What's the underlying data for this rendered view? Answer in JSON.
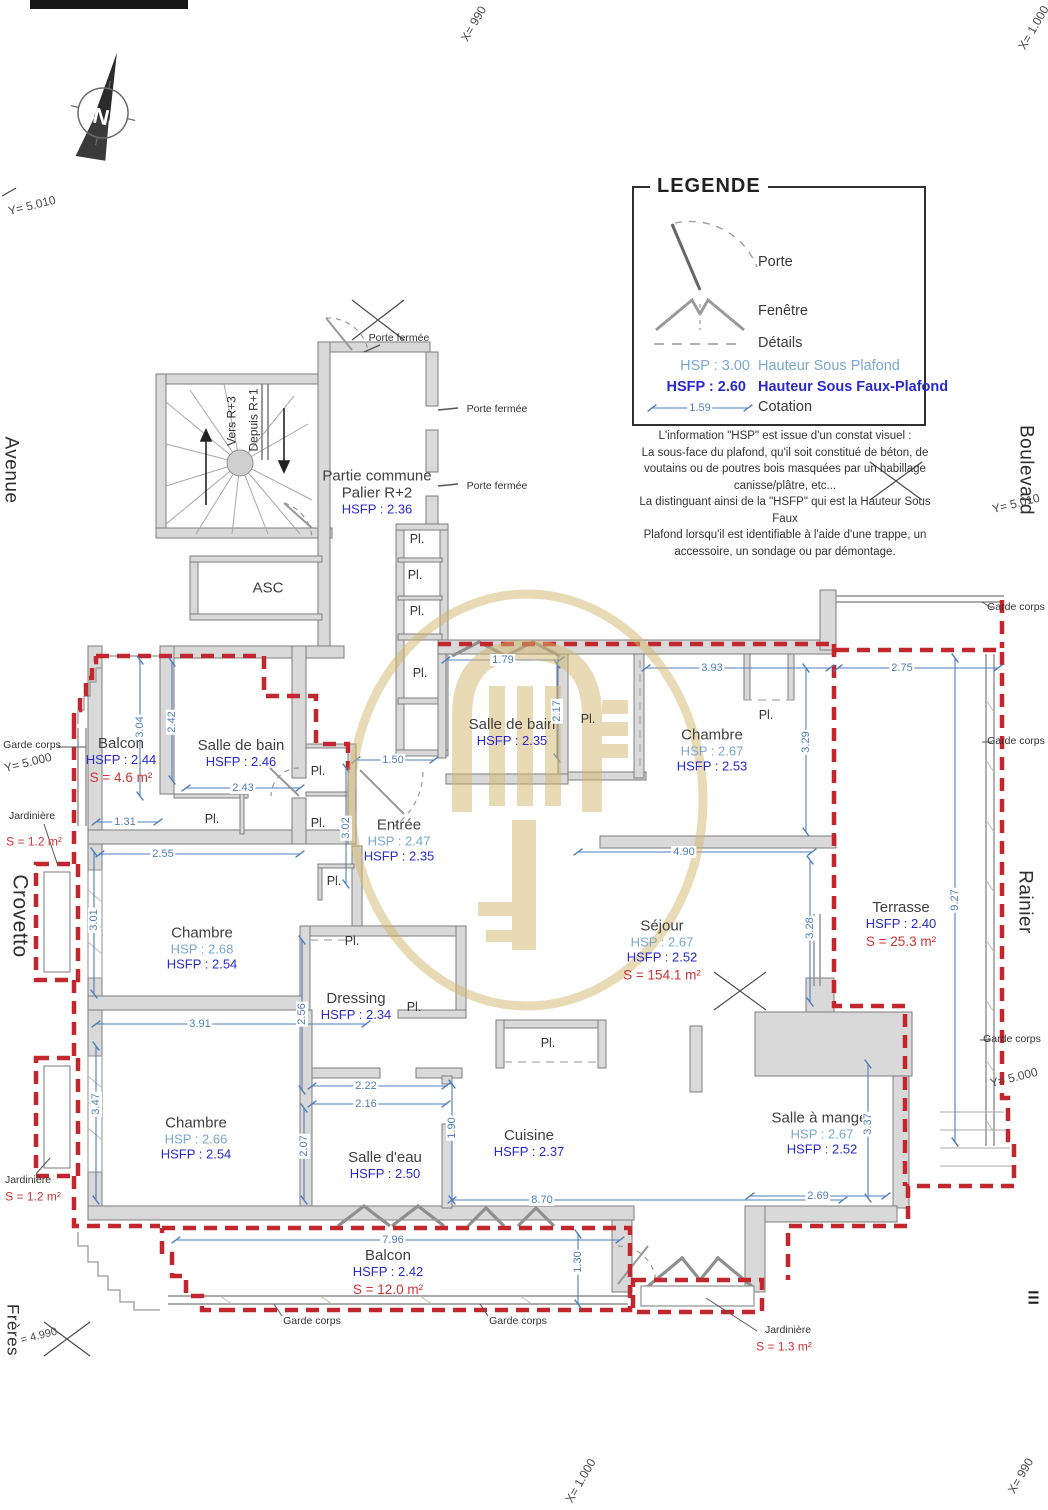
{
  "legend": {
    "title": "LEGENDE",
    "porte": "Porte",
    "fenetre": "Fenêtre",
    "details": "Détails",
    "hsp_value": "HSP : 3.00",
    "hsp_label": "Hauteur Sous Plafond",
    "hsfp_value": "HSFP : 2.60",
    "hsfp_label": "Hauteur Sous Faux-Plafond",
    "cotation_value": "1.59",
    "cotation_label": "Cotation",
    "note_lines": [
      "L'information \"HSP\" est issue d'un constat visuel :",
      "La sous-face du plafond, qu'il soit constitué de béton, de",
      "voutains ou de poutres bois masquées par un habillage",
      "canisse/plâtre, etc...",
      "La distinguant ainsi de la \"HSFP\" qui est la Hauteur Sous Faux",
      "Plafond lorsqu'il est identifiable à l'aide d'une trappe, un",
      "accessoire, un sondage ou par démontage."
    ]
  },
  "compass": {
    "north_letter": "N"
  },
  "streets": {
    "avenue": "Avenue",
    "boulevard": "Boulevard",
    "crovetto": "Crovetto",
    "rainier": "Rainier",
    "freres": "Frères",
    "numeral": "III"
  },
  "coords": {
    "y5010_left": "Y= 5.010",
    "x990_top": "X= 990",
    "x1000_topright": "X= 1.000",
    "y5010_right": "Y= 5.010",
    "y5000_left": "Y= 5.000",
    "y5000_right": "Y= 5.000",
    "y4990_bottomleft": "= 4.990",
    "x1000_bottom": "X= 1.000",
    "x990_bottomright": "X= 990"
  },
  "common_area": {
    "stairs_up": "Vers R+3",
    "stairs_down": "Depuis R+1",
    "door_closed_1": "Porte fermée",
    "door_closed_2": "Porte fermée",
    "door_closed_3": "Porte fermée"
  },
  "closet_label": "Pl.",
  "guard_label": "Garde corps",
  "planters": [
    {
      "label": "Jardinière",
      "area": "S = 1.2 m²"
    },
    {
      "label": "Jardinière",
      "area": "S = 1.2 m²"
    },
    {
      "label": "Jardinière",
      "area": "S = 1.3 m²"
    }
  ],
  "rooms": [
    {
      "name": "Partie commune",
      "name2": "Palier R+2",
      "hsfp": "HSFP : 2.36"
    },
    {
      "name": "ASC"
    },
    {
      "name": "Balcon",
      "hsfp": "HSFP : 2.44",
      "area": "S = 4.6 m²"
    },
    {
      "name": "Salle de bain",
      "hsfp": "HSFP : 2.46"
    },
    {
      "name": "Salle de bain",
      "hsfp": "HSFP : 2.35"
    },
    {
      "name": "Chambre",
      "hsp": "HSP : 2.67",
      "hsfp": "HSFP : 2.53"
    },
    {
      "name": "Entrée",
      "hsp": "HSP : 2.47",
      "hsfp": "HSFP : 2.35"
    },
    {
      "name": "Chambre",
      "hsp": "HSP : 2.68",
      "hsfp": "HSFP : 2.54"
    },
    {
      "name": "Séjour",
      "hsp": "HSP : 2.67",
      "hsfp": "HSFP : 2.52",
      "area": "S = 154.1 m²"
    },
    {
      "name": "Terrasse",
      "hsfp": "HSFP : 2.40",
      "area": "S = 25.3 m²"
    },
    {
      "name": "Dressing",
      "hsfp": "HSFP : 2.34"
    },
    {
      "name": "Chambre",
      "hsp": "HSP : 2.66",
      "hsfp": "HSFP : 2.54"
    },
    {
      "name": "Salle d'eau",
      "hsfp": "HSFP : 2.50"
    },
    {
      "name": "Cuisine",
      "hsfp": "HSFP : 2.37"
    },
    {
      "name": "Salle à manger",
      "hsp": "HSP : 2.67",
      "hsfp": "HSFP : 2.52"
    },
    {
      "name": "Balcon",
      "hsfp": "HSFP : 2.42",
      "area": "S = 12.0 m²"
    }
  ],
  "dims": [
    {
      "v": "1.79"
    },
    {
      "v": "2.17"
    },
    {
      "v": "3.93"
    },
    {
      "v": "3.29"
    },
    {
      "v": "2.75"
    },
    {
      "v": "9.27"
    },
    {
      "v": "1.50"
    },
    {
      "v": "3.02"
    },
    {
      "v": "2.42"
    },
    {
      "v": "3.04"
    },
    {
      "v": "2.43"
    },
    {
      "v": "1.31"
    },
    {
      "v": "2.55"
    },
    {
      "v": "3.01"
    },
    {
      "v": "2.56"
    },
    {
      "v": "3.91"
    },
    {
      "v": "4.90"
    },
    {
      "v": "3.28"
    },
    {
      "v": "2.22"
    },
    {
      "v": "2.16"
    },
    {
      "v": "2.07"
    },
    {
      "v": "1.90"
    },
    {
      "v": "3.47"
    },
    {
      "v": "8.70"
    },
    {
      "v": "2.69"
    },
    {
      "v": "3.37"
    },
    {
      "v": "7.96"
    },
    {
      "v": "1.30"
    }
  ]
}
